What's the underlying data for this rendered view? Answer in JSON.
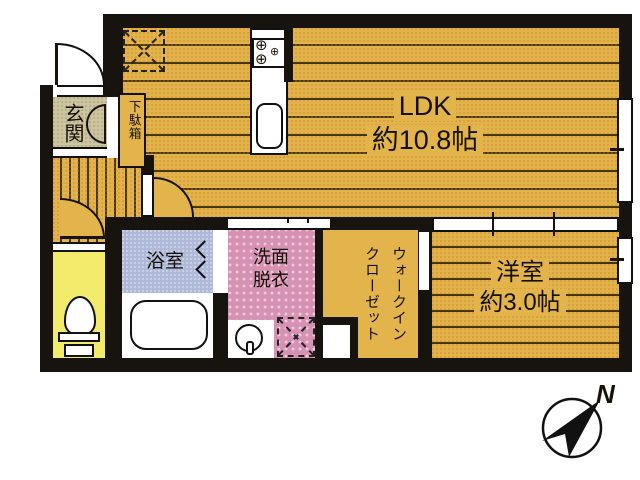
{
  "plan": {
    "rooms": {
      "ldk": {
        "label": "LDK",
        "size": "約10.8帖"
      },
      "western_room": {
        "label": "洋室",
        "size": "約3.0帖"
      },
      "entrance": {
        "label": "玄関"
      },
      "shoe_cabinet": {
        "label": "下駄箱"
      },
      "bathroom": {
        "label": "浴室"
      },
      "washroom": {
        "label": "洗面\n脱衣"
      },
      "walk_in_closet": {
        "label": "ウォークイン\nクローゼット"
      }
    },
    "compass": {
      "label": "N"
    },
    "colors": {
      "floor_gold": "#E3B44C",
      "stripe_dark": "#43360A",
      "entrance_beige": "#CCC5A0",
      "toilet_yellow": "#F2EA6A",
      "bath_blue": "#AEB9D9",
      "washroom_pink": "#D791B3",
      "wall_black": "#17130E"
    }
  }
}
